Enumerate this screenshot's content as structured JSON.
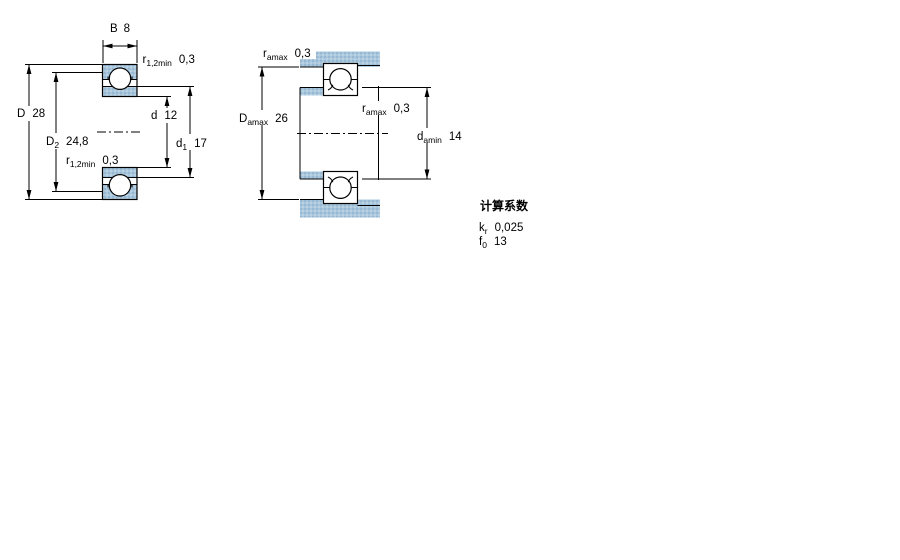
{
  "drawing": {
    "section_view": {
      "b": {
        "main": "B",
        "value": "8"
      },
      "r_top": {
        "main": "r",
        "sub": "1,2min",
        "value": "0,3"
      },
      "D": {
        "main": "D",
        "value": "28"
      },
      "D2": {
        "main": "D",
        "sub": "2",
        "value": "24,8"
      },
      "r_bottom": {
        "main": "r",
        "sub": "1,2min",
        "value": "0,3"
      },
      "d": {
        "main": "d",
        "value": "12"
      },
      "d1": {
        "main": "d",
        "sub": "1",
        "value": "17"
      }
    },
    "mounting_view": {
      "ra_top": {
        "main": "r",
        "sub": "amax",
        "value": "0,3"
      },
      "Da": {
        "main": "D",
        "sub": "amax",
        "value": "26"
      },
      "ra_mid": {
        "main": "r",
        "sub": "amax",
        "value": "0,3"
      },
      "da": {
        "main": "d",
        "sub": "amin",
        "value": "14"
      }
    },
    "calculation_factors": {
      "title": "计算系数",
      "kr": {
        "main": "k",
        "sub": "r",
        "value": "0,025"
      },
      "f0": {
        "main": "f",
        "sub": "0",
        "value": "13"
      }
    },
    "colors": {
      "section_fill": "#a9c6dc",
      "section_dot_dark": "#88accc",
      "section_dot_light": "#c6dcec",
      "line": "#000000",
      "background": "#ffffff"
    }
  }
}
